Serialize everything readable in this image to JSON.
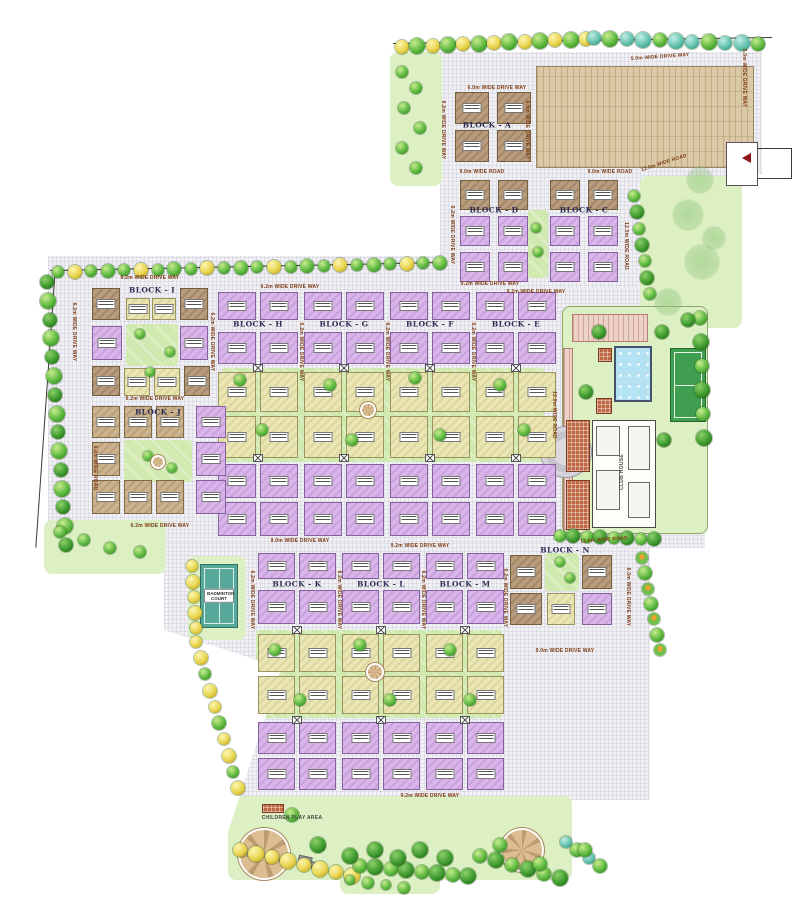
{
  "blocks": {
    "a": "BLOCK - A",
    "c": "BLOCK - C",
    "d": "BLOCK - D",
    "e": "BLOCK - E",
    "f": "BLOCK - F",
    "g": "BLOCK - G",
    "h": "BLOCK - H",
    "i": "BLOCK - I",
    "j": "BLOCK - J",
    "k": "BLOCK - K",
    "l": "BLOCK - L",
    "m": "BLOCK - M",
    "n": "BLOCK - N"
  },
  "roads": {
    "w50_drive": "5.0m WIDE DRIVE WAY",
    "w60_drive": "6.0m WIDE DRIVE WAY",
    "w62_drive": "6.2m WIDE DRIVE WAY",
    "w62_road": "6.2m WIDE ROAD",
    "w90_road": "9.0m WIDE ROAD",
    "w90_drive": "9.0m WIDE DRIVE WAY",
    "w92_drive": "9.2m WIDE DRIVE WAY",
    "w120_road": "12.0m WIDE ROAD"
  },
  "amenities": {
    "club_house": "CLUB HOUSE",
    "badminton_court": "BADMINTON COURT",
    "children_play_area": "CHILDREN PLAY AREA"
  },
  "colors": {
    "unit_purple": "#d9b5ea",
    "unit_brown": "#b89c7d",
    "unit_yellow": "#eae6b4",
    "courtyard_green": "#cfe9ae",
    "boundary_green": "#97d56e",
    "paved_grey": "#f1f0f4",
    "parking_tan": "#dbc9a6",
    "pool_blue": "#b5e2f2",
    "court_green": "#3f9e4f",
    "badminton_teal": "#57a89b",
    "entry_red": "#8e1616"
  }
}
